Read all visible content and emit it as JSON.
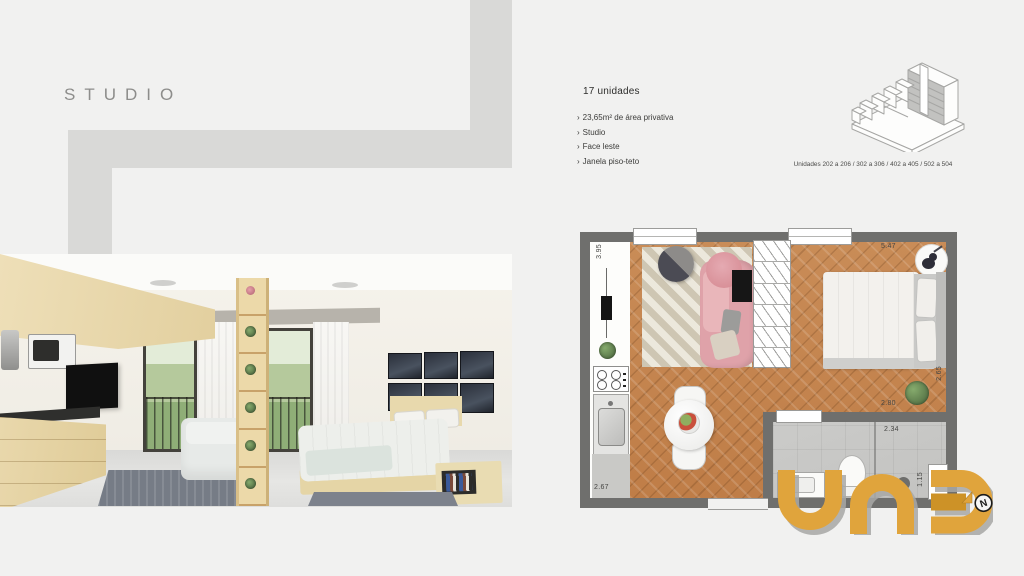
{
  "title": "STUDIO",
  "info": {
    "heading": "17 unidades",
    "bullet": "›",
    "features": [
      "23,65m² de área privativa",
      "Studio",
      "Face leste",
      "Janela piso-teto"
    ]
  },
  "building": {
    "caption": "Unidades 202 a 206 / 302 a 306 / 402 a 405 / 502 a 504"
  },
  "floorplan": {
    "dims": {
      "living_width_left": "3.95",
      "bedroom_width_top": "5.47",
      "bedroom_depth_right": "2.65",
      "bedroom_width_bottom": "2.80",
      "bathroom_width": "2.34",
      "bathroom_window": "1.15",
      "kitchen_depth": "2.67"
    }
  },
  "logo": {
    "text": "una",
    "color": "#e0a43c"
  },
  "compass": {
    "label": "N"
  },
  "colors": {
    "background": "#f1f1f0",
    "band": "#d9d9d7",
    "plan_wall": "#6f6f6d",
    "wood": "#c5884f",
    "accent_gold": "#e0a43c"
  }
}
